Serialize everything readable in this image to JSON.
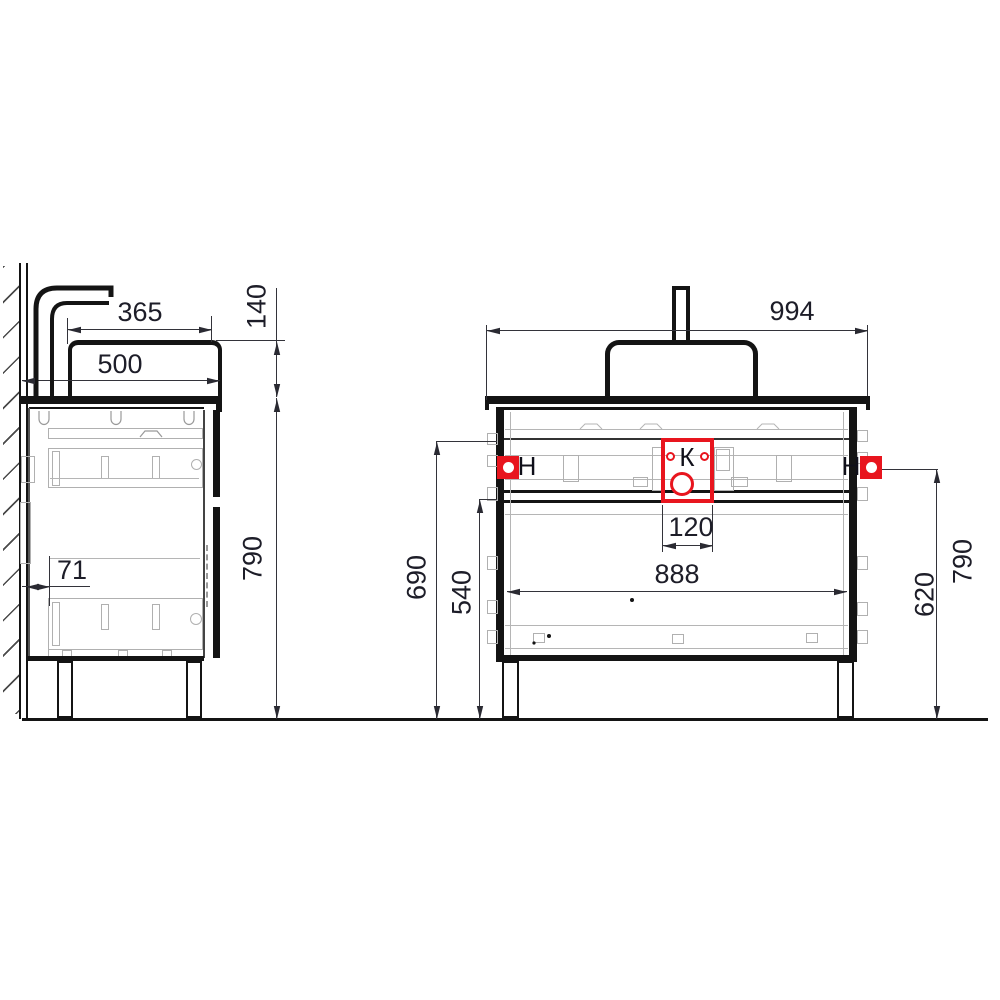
{
  "drawing_type": "vanity-cabinet-technical-drawing",
  "colors": {
    "accent_red": "#e8151e",
    "line": "#141414",
    "detail_gray": "#b5b5b5",
    "dim_text": "#1d1d28"
  },
  "side_view": {
    "dims": {
      "basin_depth": "365",
      "total_depth": "500",
      "basin_height": "140",
      "total_height": "790",
      "wall_offset": "71"
    }
  },
  "front_view": {
    "dims": {
      "total_width": "994",
      "drain_offset": "120",
      "inner_width": "888",
      "left_height": "690",
      "drawer_zone_height": "540",
      "outlet_height": "620",
      "total_height": "790"
    },
    "markers": {
      "left_outlet": "Н",
      "drain": "К",
      "right_outlet": "Н"
    }
  }
}
